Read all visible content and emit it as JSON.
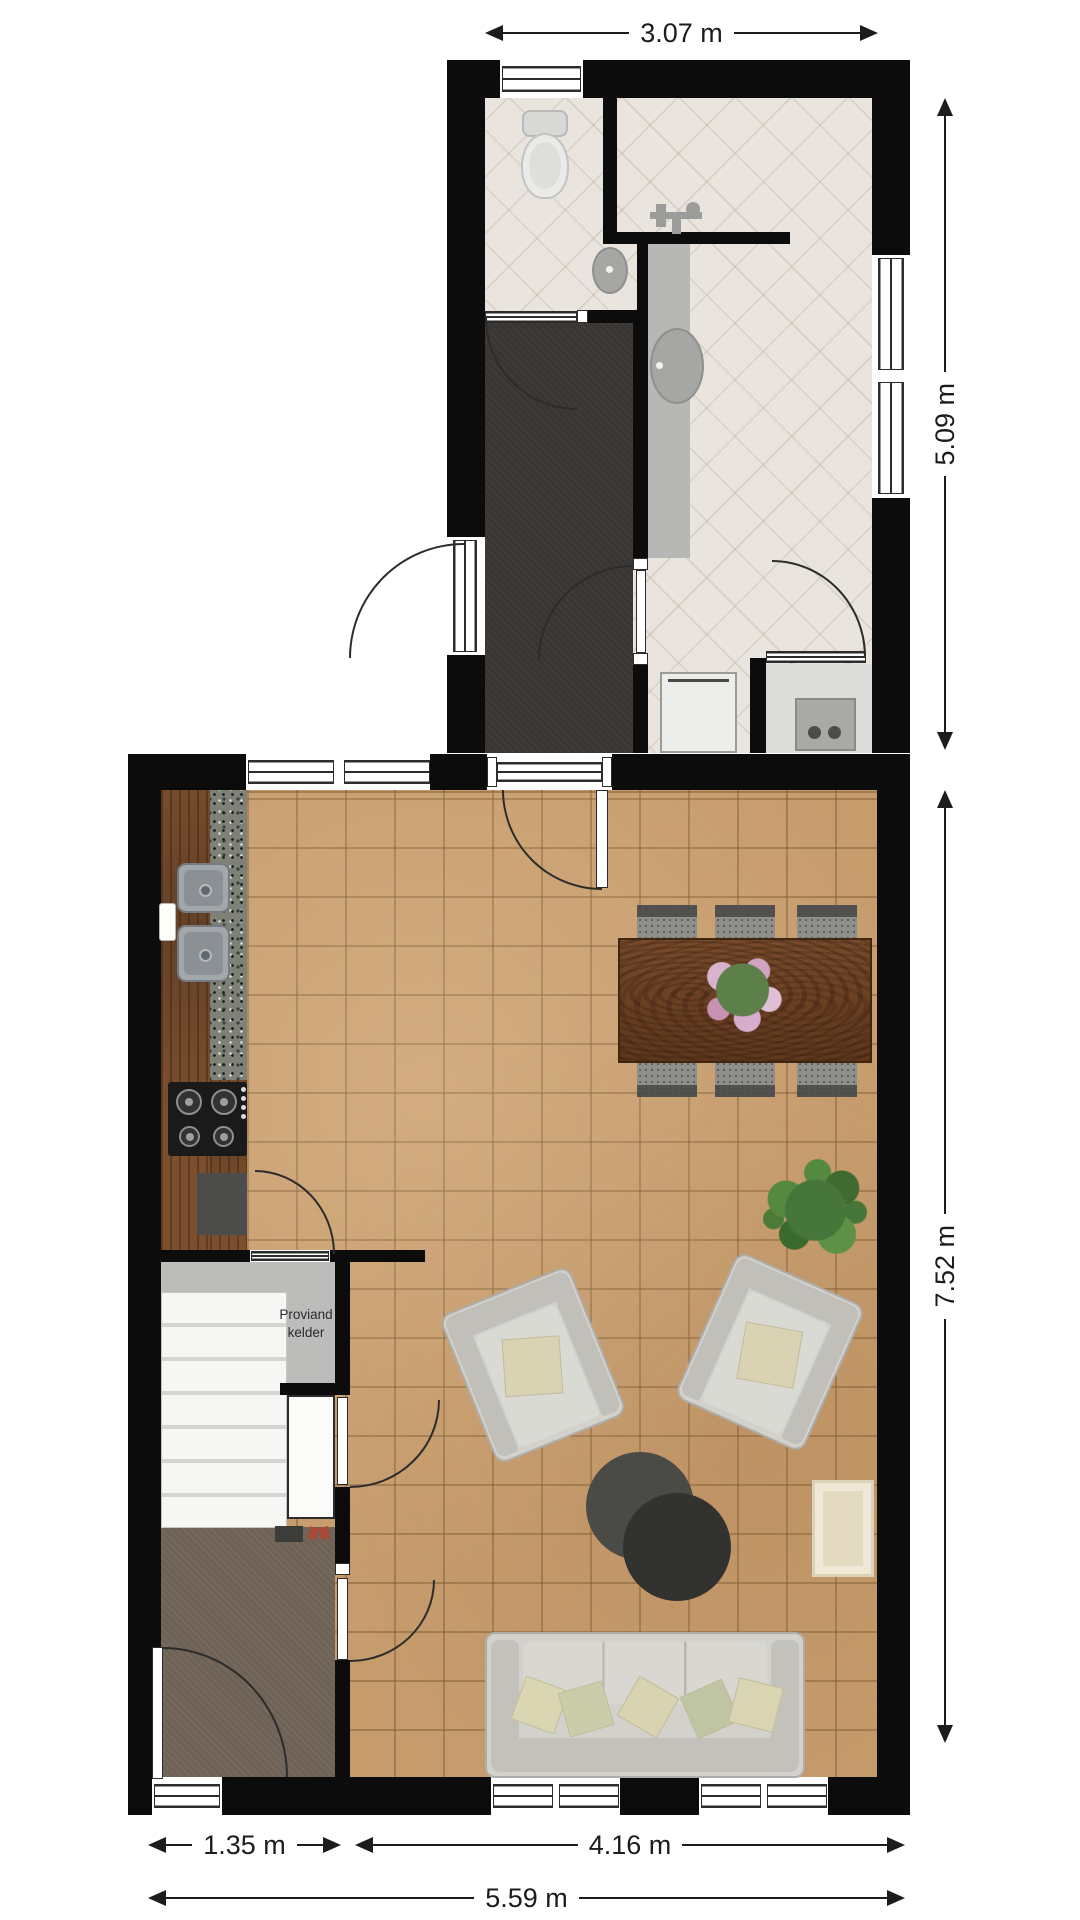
{
  "floorplan": {
    "labels": {
      "pantry_line1": "Proviand",
      "pantry_line2": "kelder"
    },
    "dimensions": {
      "annex_width": "3.07 m",
      "annex_height": "5.09 m",
      "living_height": "7.52 m",
      "hall_width": "1.35 m",
      "living_width": "4.16 m",
      "total_width": "5.59 m"
    },
    "colors": {
      "wall": "#0c0c0c",
      "annex_tile": "#e9e5de",
      "hallway_carpet": "#393532",
      "living_tile": "#c79c6d",
      "pantry_floor": "#bcbcba",
      "brown_carpet": "#6e6156",
      "wood_counter": "#7b4f2e",
      "granite": "#7e8276",
      "table_wood": "#6b3e20",
      "sofa": "#d2d1cc",
      "plant_green": "#47763a",
      "dimension_text": "#1c1c1c"
    }
  }
}
